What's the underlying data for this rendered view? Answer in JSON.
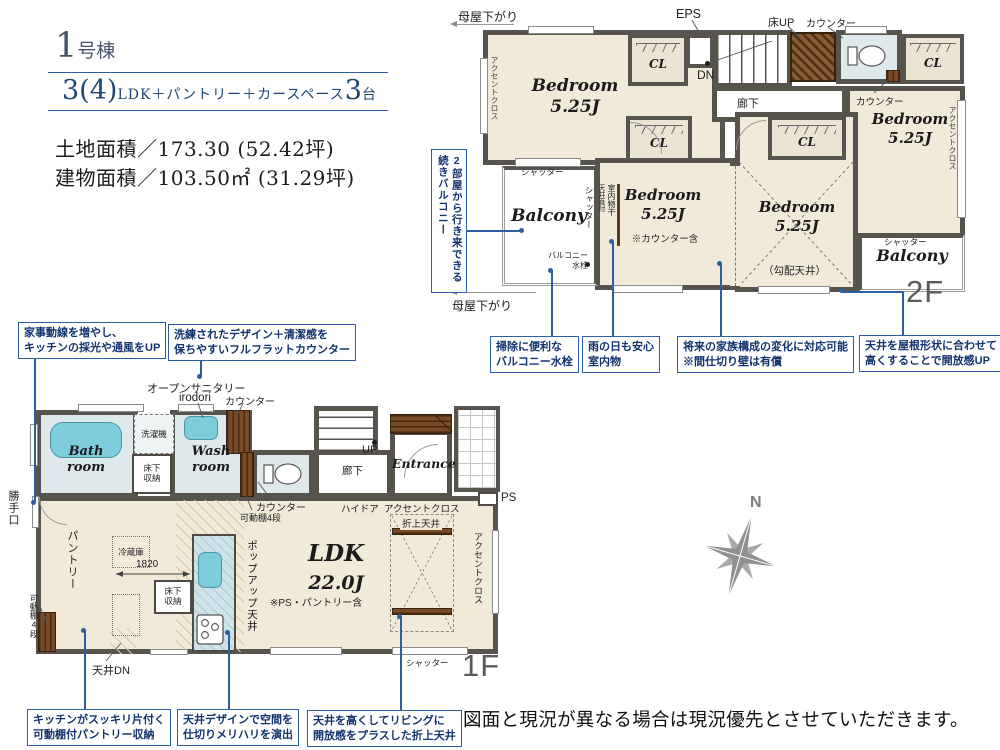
{
  "header": {
    "unit_num": "1",
    "unit_suffix": "号棟",
    "plan_num": "3(4)",
    "plan_mid": "LDK＋パントリー＋カースペース",
    "plan_cars": "3",
    "plan_cars_unit": "台",
    "land": "土地面積／173.30 (52.42坪)",
    "building": "建物面積／103.50㎡ (31.29坪)"
  },
  "common": {
    "bedroom": "Bedroom",
    "bedroom_size": "5.25J",
    "cl": "CL",
    "shutter": "シャッター",
    "accent": "アクセントクロス",
    "counter": "カウンター",
    "yukashita1": "床下",
    "yukashita2": "収納",
    "kadoudana": "可動棚4段",
    "balcony": "Balcony",
    "rouka": "廊下",
    "moya": "母屋下がり"
  },
  "f2": {
    "floor_label": "2F",
    "eps": "EPS",
    "dn": "DN",
    "yuka_up": "床UP",
    "kobai_note": "（勾配天井）",
    "counter_note": "※カウンター含",
    "monohoshi": "室内物干",
    "tenjo_jika": "天井直付",
    "suisen_l1": "バルコニー",
    "suisen_l2": "水栓"
  },
  "f1": {
    "floor_label": "1F",
    "open_sanitary": "オープンサニタリー",
    "irodori": "irodori",
    "bath1": "Bath",
    "bath2": "room",
    "wash1": "Wash",
    "wash2": "room",
    "sentakuki": "洗濯機",
    "entrance": "Entrance",
    "up": "UP",
    "haidoa": "ハイドア",
    "ps": "PS",
    "oriage": "折上天井",
    "ldk": "LDK",
    "ldk_size": "22.0J",
    "ldk_note": "※PS・パントリー含",
    "pantry": "パントリー",
    "reizouko": "冷蔵庫",
    "dim1820": "1820",
    "popup": "ポップアップ天井",
    "tenjo_dn": "天井DN",
    "katteguchi": "勝手口"
  },
  "callouts": {
    "cv1": "2部屋から行き来できる",
    "cv2": "続きバルコニー",
    "c1a": "掃除に便利な",
    "c1b": "バルコニー水栓",
    "c2a": "雨の日も安心",
    "c2b": "室内物",
    "c3a": "将来の家族構成の変化に対応可能",
    "c3b": "※間仕切り壁は有償",
    "c4a": "天井を屋根形状に合わせて",
    "c4b": "高くすることで開放感UP",
    "c5a": "家事動線を増やし、",
    "c5b": "キッチンの採光や通風をUP",
    "c6a": "洗練されたデザイン＋清潔感を",
    "c6b": "保ちやすいフルフラットカウンター",
    "c7a": "キッチンがスッキリ片付く",
    "c7b": "可動棚付パントリー収納",
    "c8a": "天井デザインで空間を",
    "c8b": "仕切りメリハリを演出",
    "c9a": "天井を高くしてリビングに",
    "c9b": "開放感をプラスした折上天井"
  },
  "footer": {
    "disclaimer": "図面と現況が異なる場合は現況優先とさせていただきます。"
  },
  "compass": {
    "north": "N"
  },
  "colors": {
    "accent_blue": "#2e5fa3",
    "callout_text": "#12336e",
    "wall": "#57544e",
    "floor": "#f1ead9",
    "water": "#dfe9ec",
    "wood": "#7a4a26",
    "tub": "#7fccdb",
    "title_navy": "#1f4670"
  }
}
